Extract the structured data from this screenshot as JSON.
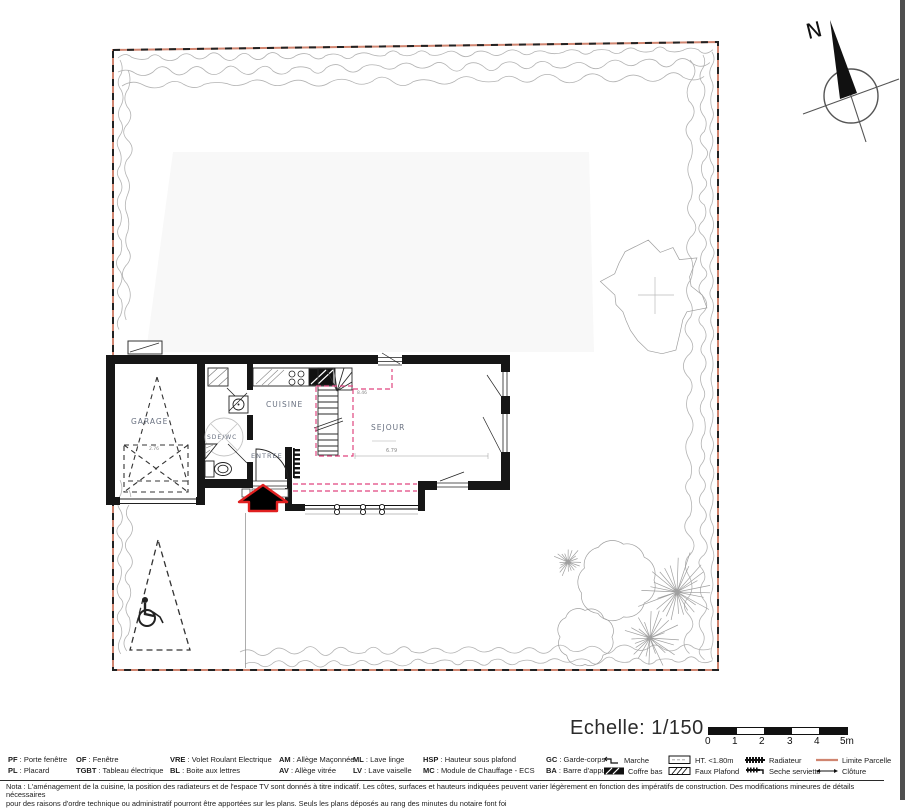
{
  "north": {
    "label": "N"
  },
  "plan": {
    "room_labels": {
      "garage": "GARAGE",
      "sdewc": "SDE/WC",
      "cuisine": "CUISINE",
      "entree": "ENTREE",
      "sejour": "SEJOUR"
    },
    "dimensions": {
      "sejour_width": "6.79",
      "stair_width": "8.46",
      "garage_door": "2.76"
    }
  },
  "scale": {
    "label": "Echelle: 1/150",
    "ticks": [
      "0",
      "1",
      "2",
      "3",
      "4",
      "5m"
    ]
  },
  "legend": {
    "sep": " : ",
    "row1": [
      {
        "abbr": "PF",
        "label": "Porte fenêtre"
      },
      {
        "abbr": "OF",
        "label": "Fenêtre"
      },
      {
        "abbr": "VRE",
        "label": "Volet Roulant Electrique"
      },
      {
        "abbr": "AM",
        "label": "Allège Maçonnée"
      },
      {
        "abbr": "ML",
        "label": "Lave linge"
      },
      {
        "abbr": "HSP",
        "label": "Hauteur sous plafond"
      },
      {
        "abbr": "GC",
        "label": "Garde-corps"
      }
    ],
    "row1_symbols": [
      {
        "name": "marche",
        "label": "Marche"
      },
      {
        "name": "ht",
        "label": "HT. <1.80m"
      },
      {
        "name": "radiateur",
        "label": "Radiateur"
      },
      {
        "name": "limite-parcelle",
        "label": "Limite Parcelle"
      }
    ],
    "row2": [
      {
        "abbr": "PL",
        "label": "Placard"
      },
      {
        "abbr": "TGBT",
        "label": "Tableau électrique"
      },
      {
        "abbr": "BL",
        "label": "Boite aux lettres"
      },
      {
        "abbr": "AV",
        "label": "Allège vitrée"
      },
      {
        "abbr": "LV",
        "label": "Lave vaiselle"
      },
      {
        "abbr": "MC",
        "label": "Module de Chauffage - ECS"
      },
      {
        "abbr": "BA",
        "label": "Barre d'appui"
      }
    ],
    "row2_symbols": [
      {
        "name": "coffre-bas",
        "label": "Coffre bas"
      },
      {
        "name": "faux-plafond",
        "label": "Faux Plafond"
      },
      {
        "name": "seche-serviette",
        "label": "Seche serviette"
      },
      {
        "name": "cloture",
        "label": "Clôture"
      }
    ]
  },
  "nota": {
    "line1": "Nota : L'aménagement de la cuisine, la position des radiateurs et de l'espace TV sont donnés à titre indicatif. Les côtes, surfaces et hauteurs indiquées peuvent varier légèrement en fonction des impératifs de construction. Des modifications mineures de détails nécessaires",
    "line2": "pour des raisons d'ordre technique ou administratif pourront être apportées sur les plans. Seuls les plans déposés au rang des minutes du notaire font foi"
  },
  "colors": {
    "limite_parcelle": "#d08570",
    "faux_plafond": "#e0457f",
    "entrance_arrow": "#e02020",
    "room_label": "#697181"
  }
}
